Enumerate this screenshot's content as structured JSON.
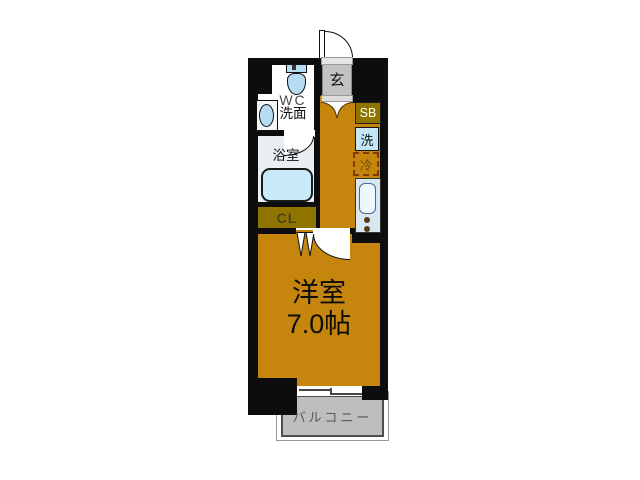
{
  "title": "1K floor plan",
  "rooms": {
    "entrance": {
      "label": "玄"
    },
    "wc": {
      "label_line1": "WC",
      "label_line2": "洗面"
    },
    "bathroom": {
      "label": "浴室"
    },
    "shoebox": {
      "label": "SB"
    },
    "washer": {
      "label": "洗"
    },
    "fridge": {
      "label": "冷"
    },
    "closet": {
      "label": "CL"
    },
    "main_room": {
      "name": "洋室",
      "size": "7.0帖"
    },
    "balcony": {
      "label": "バルコニー"
    }
  },
  "fixtures": [
    "front-door-swing",
    "toilet",
    "wash-basin",
    "bath-door-swing",
    "bathtub",
    "closet-folding-door",
    "room-door-swing",
    "kitchen-sink",
    "stove-burners",
    "sliding-window",
    "genkan-door-fan"
  ],
  "colors": {
    "wall": "#0D0D0D",
    "floor": "#C6860D",
    "olive": "#8F7500",
    "olive_text": "#4F4416",
    "genkan_gray": "#C2C2C2",
    "balcony_fill": "#BEBEBE",
    "balcony_text": "#595959",
    "fixture_blue": "#B5DCF2",
    "tub_blue": "#C9EBF9",
    "washer_blue": "#C2E8F5",
    "counter_blue": "#D9E7F2",
    "bathroom_floor": "#E9EFF3",
    "fridge_dash": "#803C00",
    "fridge_text": "#6B4D00"
  }
}
